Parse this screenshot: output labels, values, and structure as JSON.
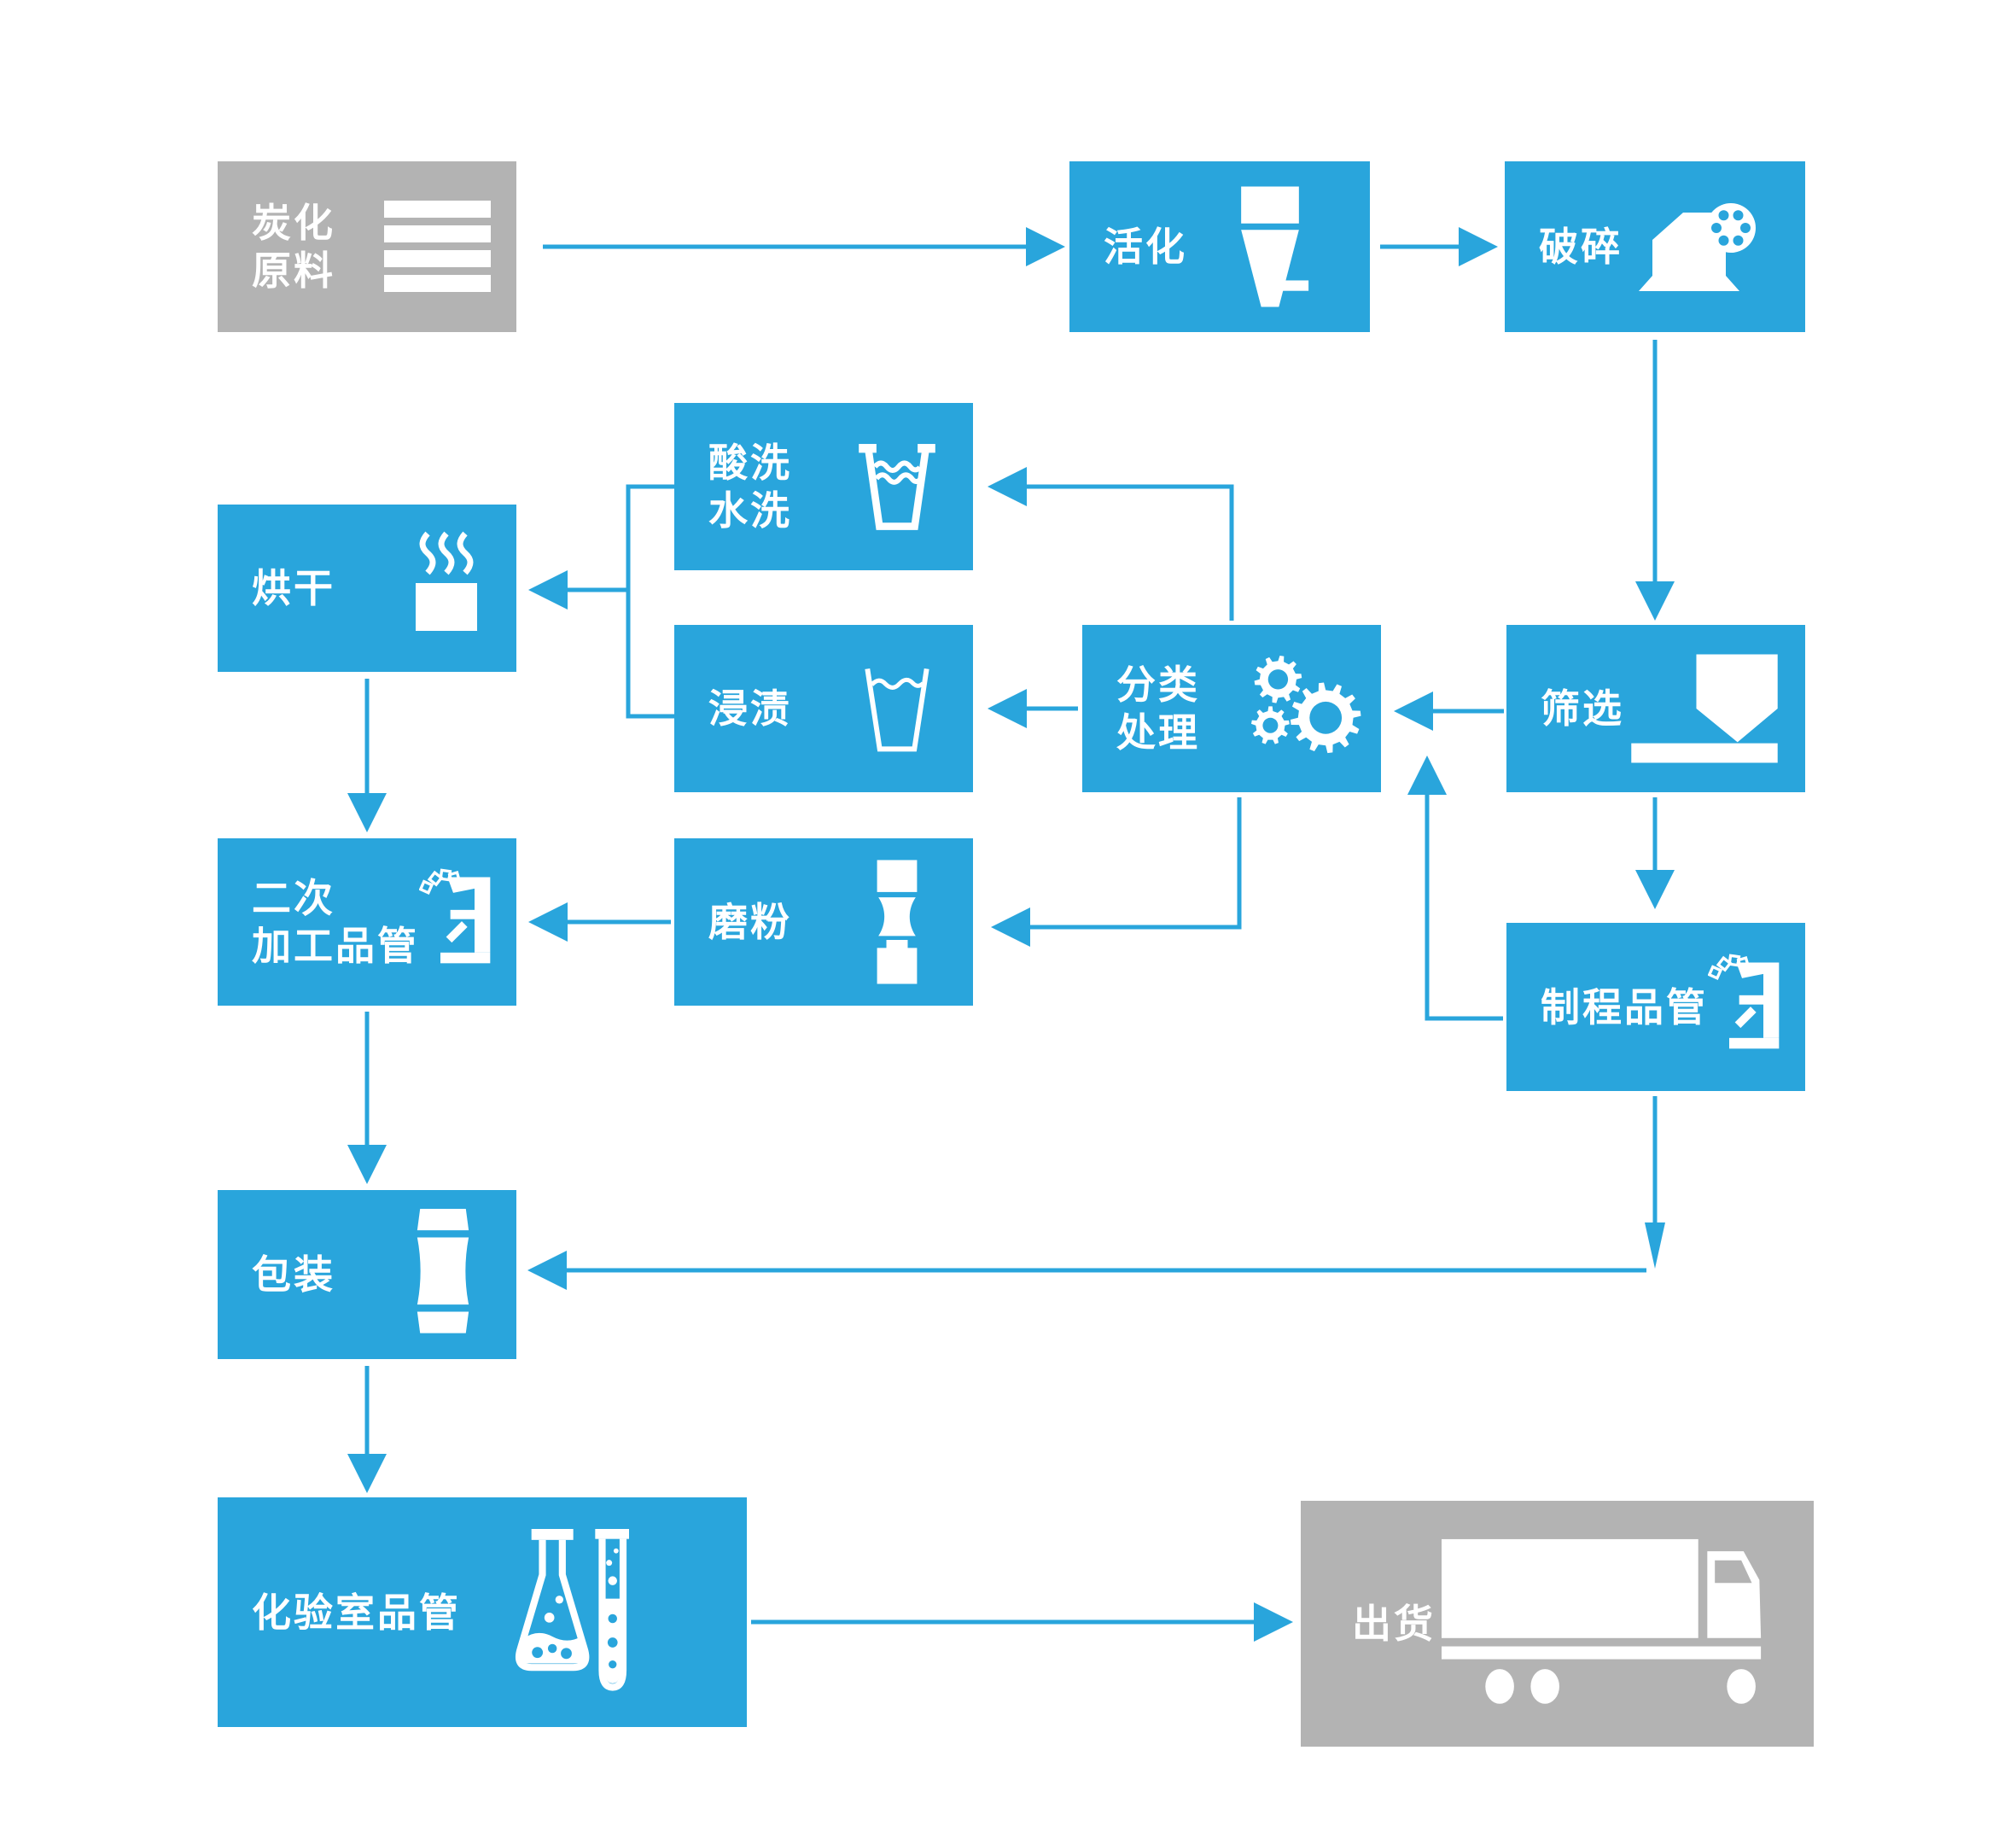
{
  "diagram": {
    "type": "flowchart",
    "language": "zh",
    "subject": "activated-carbon production process"
  },
  "theme": {
    "box_blue": "#29a5dc",
    "box_gray": "#b3b3b3",
    "connector_blue": "#29a5dc",
    "label_text": "#ffffff",
    "background": "#ffffff"
  },
  "nodes": {
    "carbonized_raw": {
      "label": "炭化原料",
      "lines": [
        "炭化",
        "原料"
      ],
      "icon": "material-stack-icon",
      "color": "gray"
    },
    "activation": {
      "label": "活化",
      "lines": [
        "活化"
      ],
      "icon": "funnel-icon",
      "color": "blue"
    },
    "crushing": {
      "label": "破碎",
      "lines": [
        "破碎"
      ],
      "icon": "crusher-icon",
      "color": "blue"
    },
    "screening": {
      "label": "筛选",
      "lines": [
        "筛选"
      ],
      "icon": "sieve-icon",
      "color": "blue"
    },
    "classification": {
      "label": "分类处理",
      "lines": [
        "分类",
        "处理"
      ],
      "icon": "gears-icon",
      "color": "blue"
    },
    "acid_wash": {
      "label": "酸洗水洗",
      "lines": [
        "酸洗",
        "水洗"
      ],
      "icon": "water-glass-icon",
      "color": "blue"
    },
    "impregnation": {
      "label": "浸渍",
      "lines": [
        "浸渍"
      ],
      "icon": "glass-icon",
      "color": "blue"
    },
    "drying": {
      "label": "烘干",
      "lines": [
        "烘干"
      ],
      "icon": "steam-cup-icon",
      "color": "blue"
    },
    "secondary_qc": {
      "label": "二次加工品管",
      "lines": [
        "二次",
        "加工品管"
      ],
      "icon": "microscope-icon",
      "color": "blue"
    },
    "grinding": {
      "label": "磨粉",
      "lines": [
        "磨粉"
      ],
      "icon": "mill-icon",
      "color": "blue"
    },
    "process_qc": {
      "label": "制程品管",
      "lines": [
        "制程品管"
      ],
      "icon": "microscope-icon",
      "color": "blue"
    },
    "packaging": {
      "label": "包装",
      "lines": [
        "包装"
      ],
      "icon": "package-icon",
      "color": "blue"
    },
    "lab_qc": {
      "label": "化验室品管",
      "lines": [
        "化验室品管"
      ],
      "icon": "flasks-icon",
      "color": "blue"
    },
    "shipping": {
      "label": "出货",
      "lines": [
        "出货"
      ],
      "icon": "truck-icon",
      "color": "gray"
    }
  },
  "edges": [
    {
      "from": "carbonized_raw",
      "to": "activation"
    },
    {
      "from": "activation",
      "to": "crushing"
    },
    {
      "from": "crushing",
      "to": "screening"
    },
    {
      "from": "screening",
      "to": "classification"
    },
    {
      "from": "classification",
      "to": "acid_wash"
    },
    {
      "from": "classification",
      "to": "impregnation"
    },
    {
      "from": "acid_wash",
      "to": "drying"
    },
    {
      "from": "impregnation",
      "to": "drying"
    },
    {
      "from": "classification",
      "to": "grinding"
    },
    {
      "from": "grinding",
      "to": "secondary_qc"
    },
    {
      "from": "drying",
      "to": "secondary_qc"
    },
    {
      "from": "screening",
      "to": "process_qc"
    },
    {
      "from": "process_qc",
      "to": "classification",
      "note": "rework loop"
    },
    {
      "from": "process_qc",
      "to": "packaging"
    },
    {
      "from": "secondary_qc",
      "to": "packaging"
    },
    {
      "from": "packaging",
      "to": "lab_qc"
    },
    {
      "from": "lab_qc",
      "to": "shipping"
    }
  ]
}
